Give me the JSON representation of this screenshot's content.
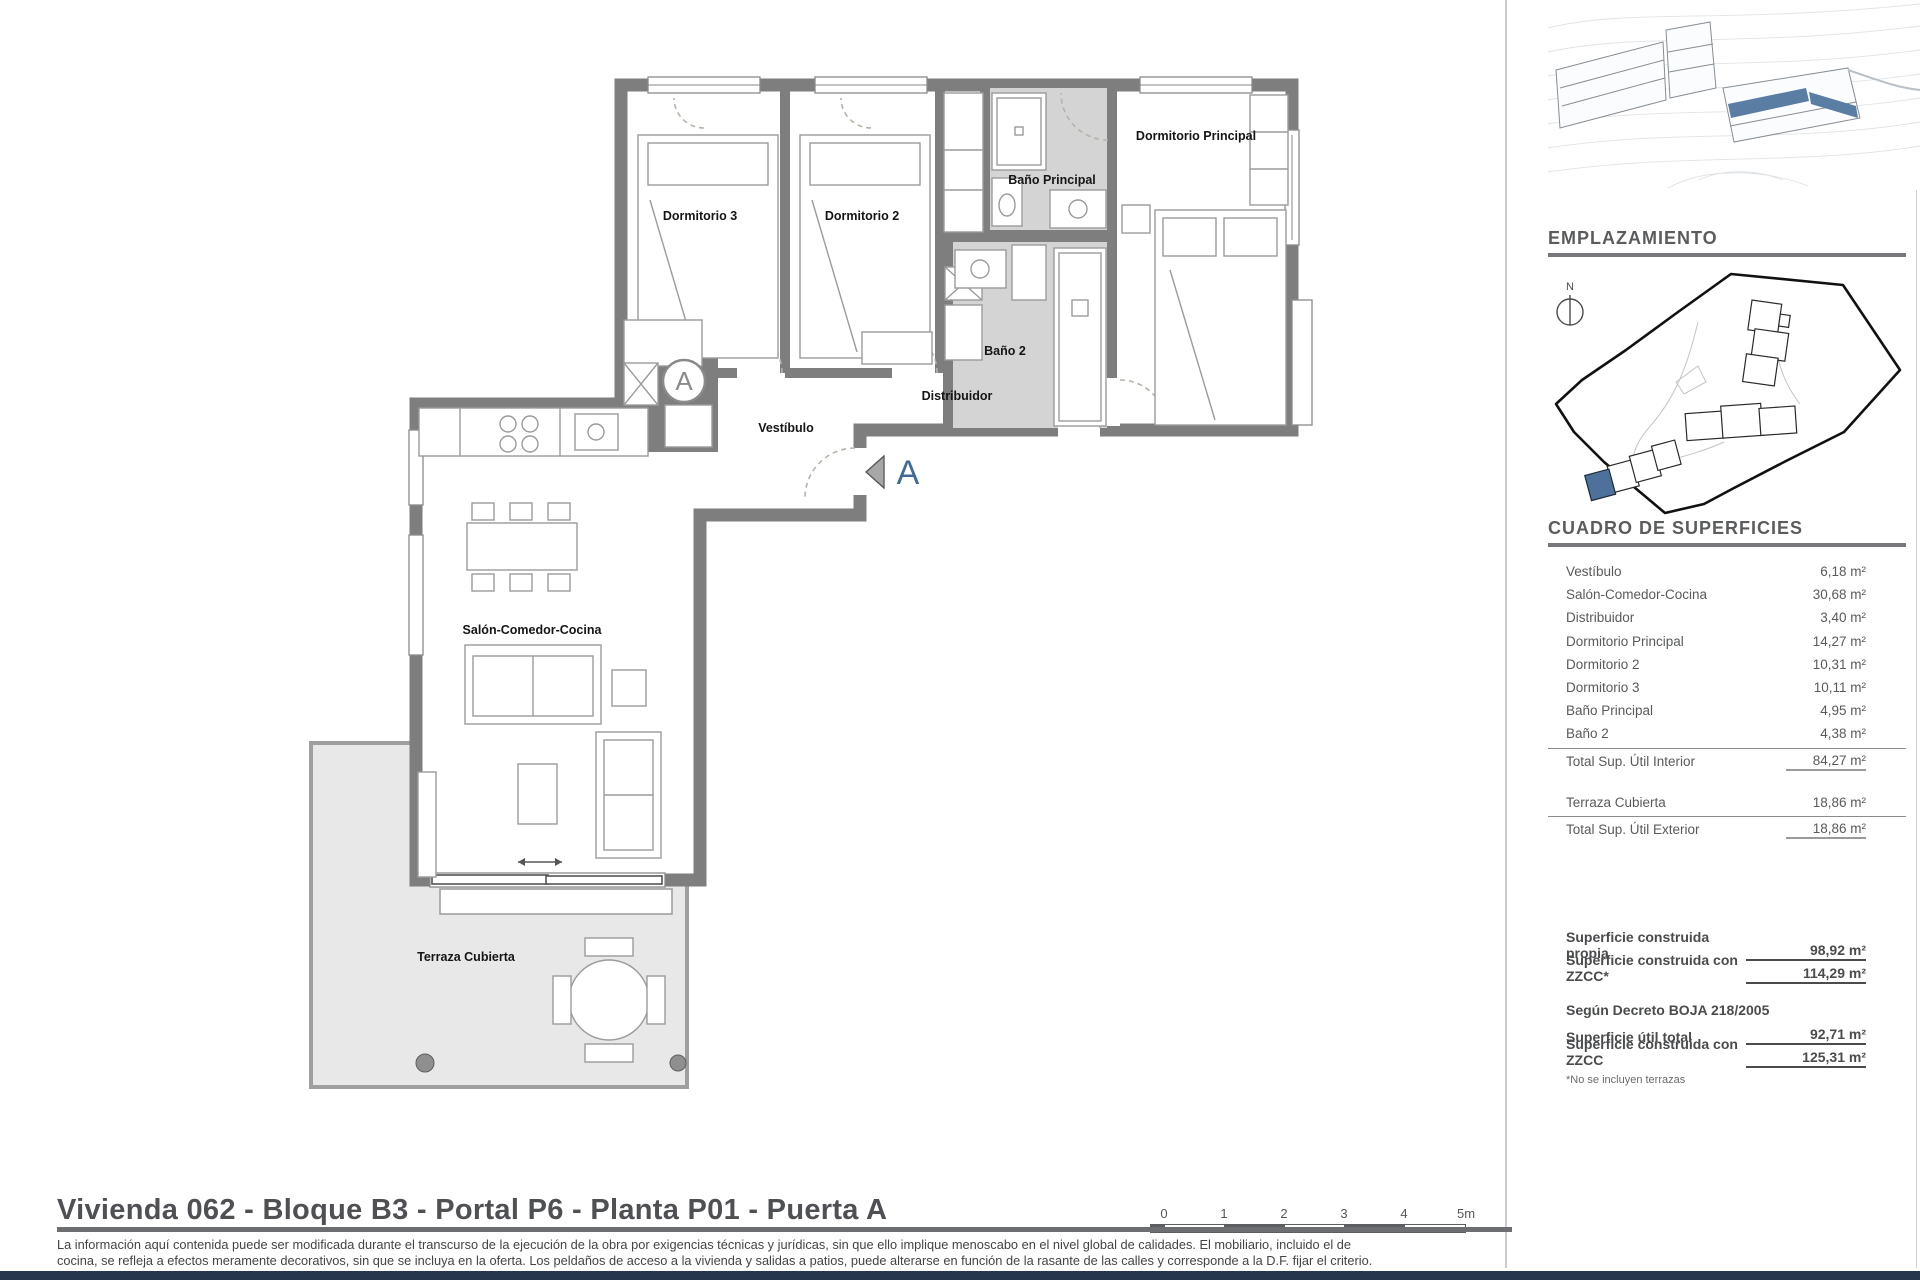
{
  "colors": {
    "accent_blue": "#4d719a",
    "wall_gray": "#7e7e7e",
    "navy_bar": "#26364d",
    "bath_fill": "#d4d4d4",
    "terrace_fill": "#e8e8e8"
  },
  "plan": {
    "labels": {
      "dormitorio3": "Dormitorio 3",
      "dormitorio2": "Dormitorio 2",
      "bano_principal": "Baño Principal",
      "dormitorio_principal": "Dormitorio Principal",
      "bano2": "Baño 2",
      "distribuidor": "Distribuidor",
      "vestibulo": "Vestíbulo",
      "salon": "Salón-Comedor-Cocina",
      "terraza": "Terraza Cubierta",
      "door_letter": "A",
      "section_letter": "A"
    }
  },
  "sidebar": {
    "emplazamiento_title": "EMPLAZAMIENTO",
    "north_label": "N",
    "cuadro_title": "CUADRO DE SUPERFICIES",
    "areas": [
      {
        "name": "Vestíbulo",
        "value": "6,18 m²"
      },
      {
        "name": "Salón-Comedor-Cocina",
        "value": "30,68 m²"
      },
      {
        "name": "Distribuidor",
        "value": "3,40 m²"
      },
      {
        "name": "Dormitorio Principal",
        "value": "14,27 m²"
      },
      {
        "name": "Dormitorio 2",
        "value": "10,31 m²"
      },
      {
        "name": "Dormitorio 3",
        "value": "10,11 m²"
      },
      {
        "name": "Baño Principal",
        "value": "4,95 m²"
      },
      {
        "name": "Baño 2",
        "value": "4,38 m²"
      }
    ],
    "total_interior": {
      "name": "Total Sup. Útil Interior",
      "value": "84,27 m²"
    },
    "terraza_row": {
      "name": "Terraza Cubierta",
      "value": "18,86 m²"
    },
    "total_exterior": {
      "name": "Total Sup. Útil Exterior",
      "value": "18,86 m²"
    },
    "summary": {
      "construida_propia": {
        "name": "Superficie construida propia",
        "value": "98,92 m²"
      },
      "construida_zzcc": {
        "name": "Superficie construida con ZZCC*",
        "value": "114,29 m²"
      },
      "decreto": "Según Decreto BOJA 218/2005",
      "util_total": {
        "name": "Superficie útil total",
        "value": "92,71 m²"
      },
      "construida_zzcc2": {
        "name": "Superficie construida con ZZCC",
        "value": "125,31 m²"
      },
      "footnote": "*No se incluyen terrazas"
    }
  },
  "footer": {
    "title": "Vivienda 062 - Bloque B3 - Portal P6 - Planta P01 - Puerta A",
    "disclaimer_line1": "La información aquí contenida puede ser modificada durante el transcurso de la ejecución de la obra por exigencias técnicas y jurídicas, sin que ello implique menoscabo en el nivel global de calidades. El mobiliario, incluido el de",
    "disclaimer_line2": "cocina, se refleja a efectos meramente decorativos, sin que se incluya en la oferta. Los peldaños de acceso a la vivienda y salidas a patios, puede alterarse en función de la rasante de las calles y corresponde a la D.F. fijar el criterio.",
    "scale_labels": [
      "0",
      "1",
      "2",
      "3",
      "4",
      "5m"
    ]
  }
}
